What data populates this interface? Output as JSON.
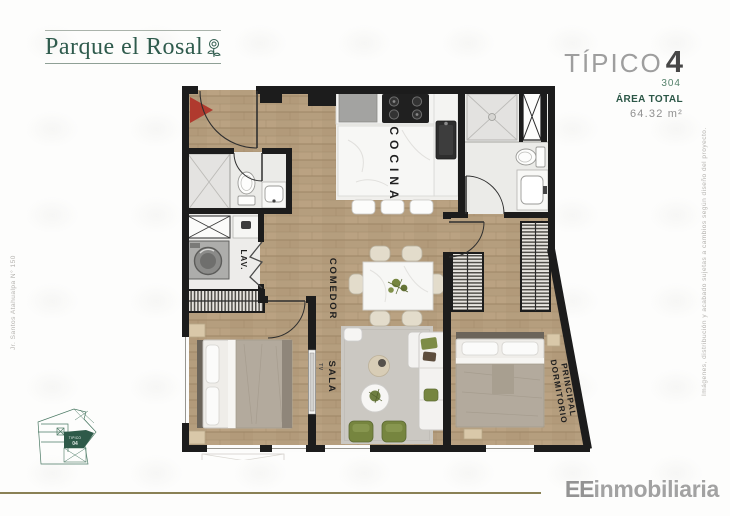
{
  "header": {
    "logo_text": "Parque el Rosal",
    "unit": {
      "type_label": "TÍPICO",
      "type_number": "4",
      "unit_number": "304",
      "area_label": "ÁREA TOTAL",
      "area_value": "64.32 m²"
    }
  },
  "margins": {
    "left_text": "Jr. Santos Atahualpa N° 150",
    "right_text": "Imágenes, distribución y acabado sujetas a cambios según diseño del proyecto."
  },
  "floorplan": {
    "labels": {
      "kitchen": "COCINA",
      "dining": "COMEDOR",
      "living": "SALA",
      "laundry": "LAV.",
      "tv": "TV",
      "master_line1": "DORMITORIO",
      "master_line2": "PRINCIPAL"
    },
    "colors": {
      "wall": "#1c1c1c",
      "wood_floor": "#b59e7e",
      "entry_arrow": "#b03a2e",
      "accent_green": "#76853f",
      "keyplan_green": "#2e5a49"
    }
  },
  "keyplan": {
    "unit_line1": "TIPICO",
    "unit_line2": "04"
  },
  "footer": {
    "divider_color": "#8a8155",
    "logo_bold": "EE",
    "logo_rest": "inmobiliaria"
  }
}
